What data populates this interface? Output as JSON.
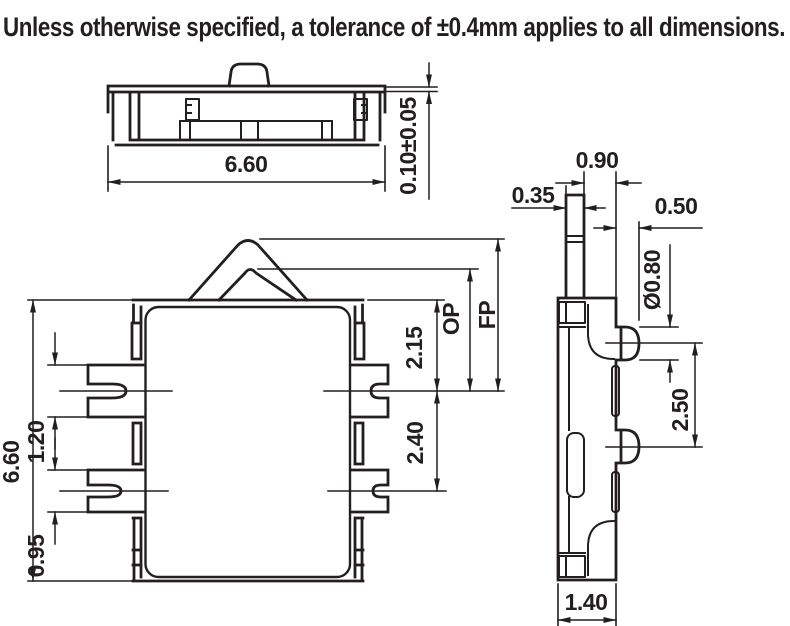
{
  "title": "Unless otherwise specified, a tolerance of ±0.4mm applies to all dimensions.",
  "colors": {
    "line": "#231f20",
    "background": "#ffffff"
  },
  "views": {
    "top": {
      "label": "top-view",
      "dims": {
        "width": "6.60",
        "step_height": "0.10±0.05"
      }
    },
    "front": {
      "label": "front-view",
      "dims": {
        "height": "6.60",
        "terminal1_width": "1.20",
        "terminal2_width": "0.95",
        "edge_to_terminal1": "2.15",
        "terminal_pitch": "2.40",
        "operating_position": "OP",
        "free_position": "FP"
      }
    },
    "side": {
      "label": "side-view",
      "dims": {
        "stem_to_edge": "0.90",
        "stem_width": "0.35",
        "pin_protrusion": "0.50",
        "pin_diameter": "Ø0.80",
        "pin_pitch": "2.50",
        "depth": "1.40"
      }
    }
  }
}
